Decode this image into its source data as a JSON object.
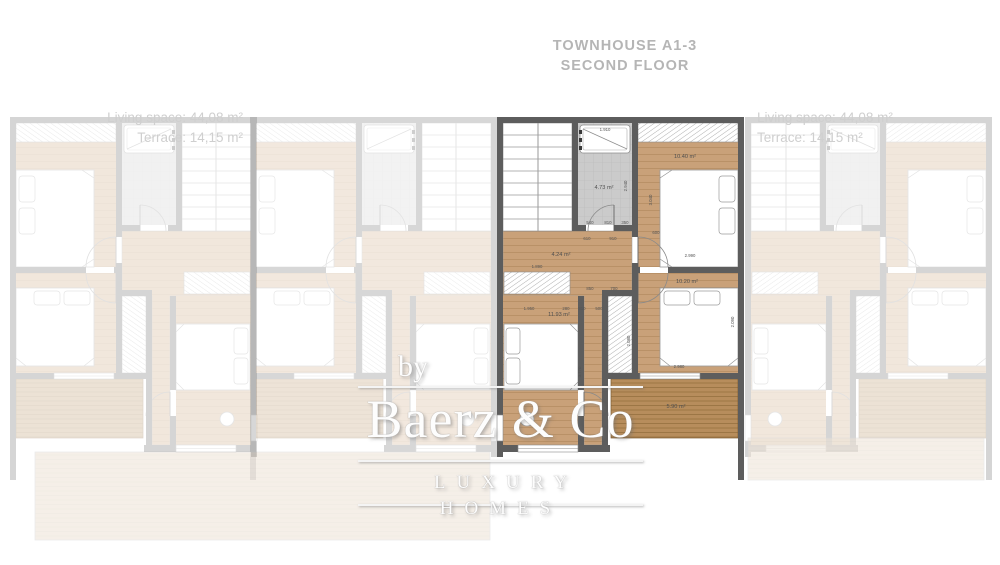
{
  "header": {
    "title_line1": "TOWNHOUSE A1-3",
    "title_line2": "SECOND FLOOR"
  },
  "left_unit_stats": {
    "living_space": "Living space: 44,08 m²",
    "terrace": "Terrace: 14,15 m²"
  },
  "right_unit_stats": {
    "living_space": "Living space: 44,08 m²",
    "terrace": "Terrace: 14,15 m²"
  },
  "watermark": {
    "by": "by",
    "brand": "Baerz & Co",
    "tagline": "LUXURY HOMES"
  },
  "colors": {
    "wall": "#5d5d5d",
    "wood_floor": "#c9a179",
    "terrace_deck": "#b78d5c",
    "bath_tile": "#cccccc",
    "faded_text": "#cfcfcf",
    "title_text": "#b5b5b5",
    "watermark_text": "#fdfdfd"
  },
  "floorplan": {
    "room_labels": [
      {
        "name": "bathroom-area-label",
        "text": "4.73 m²",
        "x": 604,
        "y": 189
      },
      {
        "name": "hall-area-label",
        "text": "4.24 m²",
        "x": 561,
        "y": 256
      },
      {
        "name": "bedroom1-area-label",
        "text": "10.40 m²",
        "x": 685,
        "y": 158
      },
      {
        "name": "bedroom2-area-label",
        "text": "10.20 m²",
        "x": 687,
        "y": 283
      },
      {
        "name": "bedroom3-area-label",
        "text": "11.93 m²",
        "x": 559,
        "y": 316
      },
      {
        "name": "terrace-area-label",
        "text": "5.90 m²",
        "x": 676,
        "y": 408
      }
    ],
    "dimension_labels": [
      {
        "text": "1.910",
        "x": 605,
        "y": 131
      },
      {
        "text": "2.940",
        "x": 627,
        "y": 186,
        "rot": -90
      },
      {
        "text": "3.040",
        "x": 652,
        "y": 200,
        "rot": -90
      },
      {
        "text": "540",
        "x": 590,
        "y": 224
      },
      {
        "text": "810",
        "x": 608,
        "y": 224
      },
      {
        "text": "350",
        "x": 625,
        "y": 224
      },
      {
        "text": "600",
        "x": 656,
        "y": 234
      },
      {
        "text": "610",
        "x": 587,
        "y": 240
      },
      {
        "text": "910",
        "x": 613,
        "y": 240
      },
      {
        "text": "1.890",
        "x": 537,
        "y": 268
      },
      {
        "text": "2.990",
        "x": 690,
        "y": 257
      },
      {
        "text": "850",
        "x": 590,
        "y": 290
      },
      {
        "text": "700",
        "x": 614,
        "y": 290
      },
      {
        "text": "1.950",
        "x": 529,
        "y": 310
      },
      {
        "text": "280",
        "x": 566,
        "y": 310
      },
      {
        "text": "810",
        "x": 582,
        "y": 310
      },
      {
        "text": "500",
        "x": 599,
        "y": 310
      },
      {
        "text": "2.980",
        "x": 679,
        "y": 368
      },
      {
        "text": "2.090",
        "x": 734,
        "y": 322,
        "rot": -90
      },
      {
        "text": "2.080",
        "x": 630,
        "y": 341,
        "rot": -90
      },
      {
        "text": "3.770",
        "x": 581,
        "y": 372,
        "rot": -90
      }
    ]
  }
}
